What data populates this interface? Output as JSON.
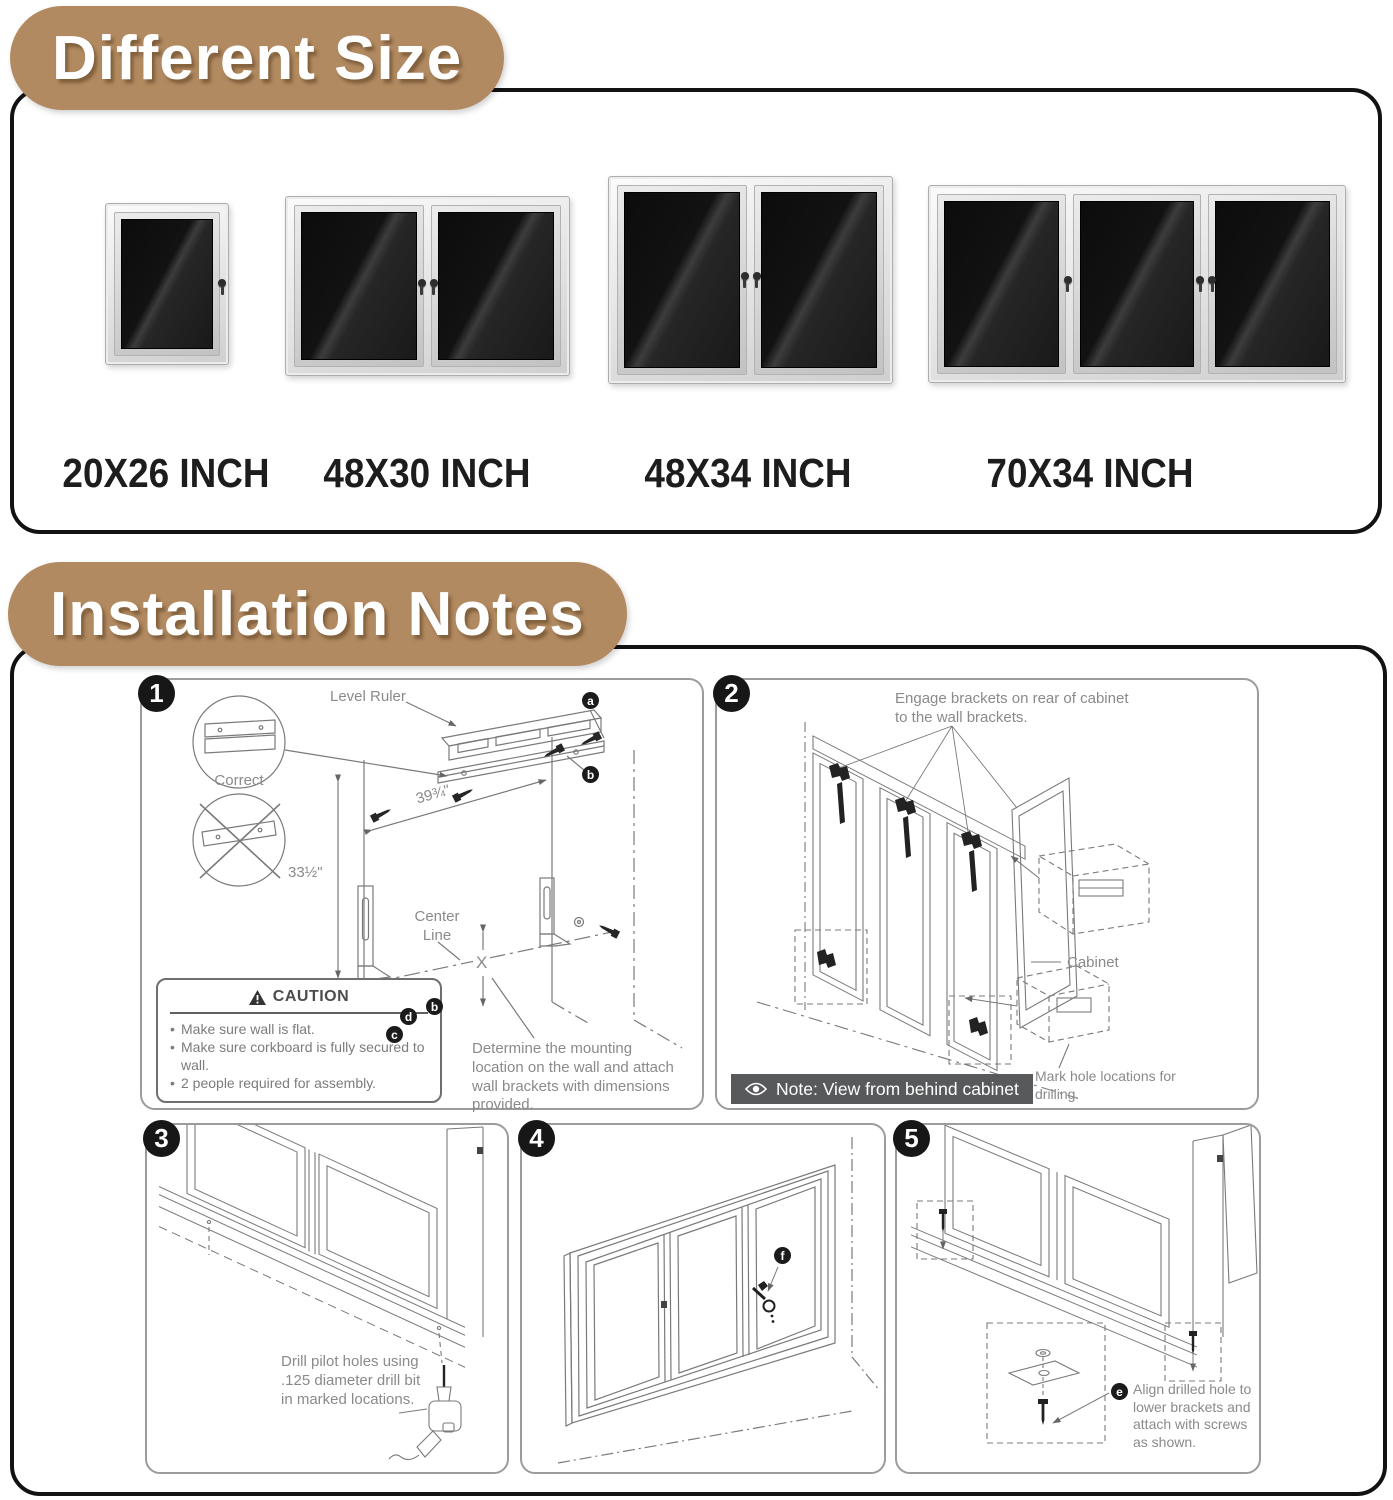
{
  "different_size": {
    "title": "Different Size",
    "sizes": [
      {
        "label": "20X26 INCH",
        "doors": 1
      },
      {
        "label": "48X30 INCH",
        "doors": 2
      },
      {
        "label": "48X34 INCH",
        "doors": 2
      },
      {
        "label": "70X34 INCH",
        "doors": 3
      }
    ]
  },
  "installation": {
    "title": "Installation Notes",
    "step1": {
      "number": "1",
      "level_ruler_label": "Level Ruler",
      "correct_label": "Correct",
      "width_dimension": "39¾\"",
      "height_dimension": "33½\"",
      "center_line_label": "Center Line",
      "x_label": "X",
      "callout_a": "a",
      "callout_b": "b",
      "callout_c": "c",
      "callout_d": "d",
      "caution": {
        "title": "CAUTION",
        "items": [
          "Make sure wall is flat.",
          "Make sure corkboard is fully secured to wall.",
          "2 people required for assembly."
        ]
      },
      "instruction": "Determine the mounting location on the wall and attach wall brackets with dimensions provided."
    },
    "step2": {
      "number": "2",
      "engage_instruction": "Engage brackets on rear of cabinet to the wall brackets.",
      "cabinet_label": "Cabinet",
      "mark_instruction": "Mark hole locations for drilling.",
      "view_note": "Note: View from behind cabinet"
    },
    "step3": {
      "number": "3",
      "instruction": "Drill pilot holes using .125 diameter drill bit in marked locations."
    },
    "step4": {
      "number": "4",
      "callout_f": "f"
    },
    "step5": {
      "number": "5",
      "callout_e": "e",
      "instruction": "Align drilled hole to lower brackets and attach with screws as shown."
    }
  },
  "colors": {
    "accent_tan": "#b28a61",
    "note_bar": "#58595b",
    "line_gray": "#7a7a7a",
    "text_gray": "#8a8a8a",
    "felt_black": "#121212"
  }
}
